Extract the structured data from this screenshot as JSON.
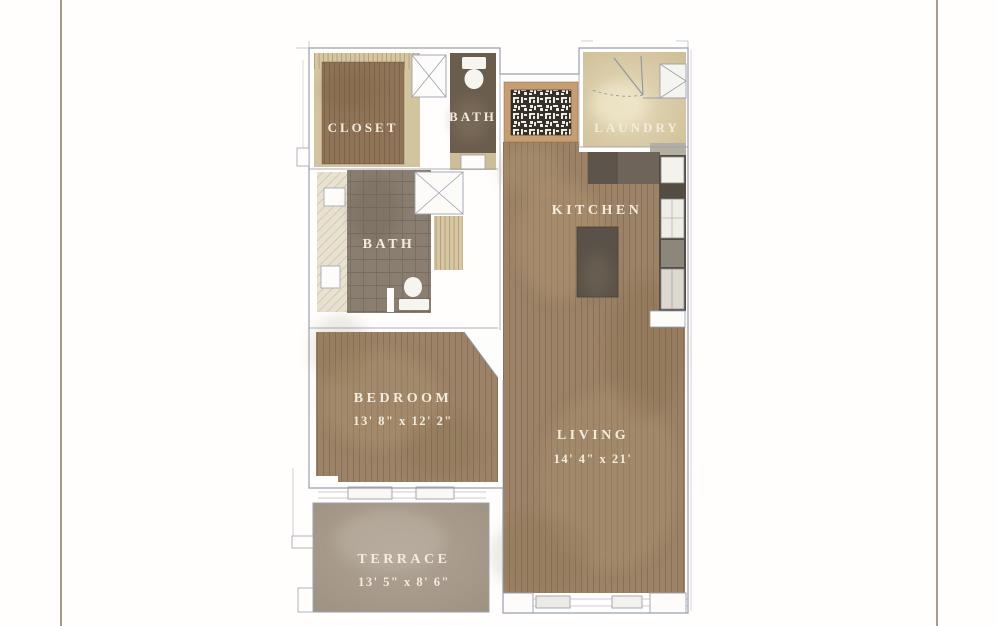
{
  "page": {
    "background": "#fffefd",
    "border_lines": {
      "color": "#a89b82",
      "left_x": 60,
      "right_x": 936
    }
  },
  "floorplan": {
    "rooms": {
      "closet": {
        "label": "CLOSET"
      },
      "bath_upper": {
        "label": "BATH"
      },
      "laundry": {
        "label": "LAUNDRY"
      },
      "kitchen": {
        "label": "KITCHEN"
      },
      "bath_main": {
        "label": "BATH"
      },
      "bedroom": {
        "label": "BEDROOM",
        "dimensions": "13' 8\" x 12' 2\""
      },
      "living": {
        "label": "LIVING",
        "dimensions": "14' 4\" x 21'"
      },
      "terrace": {
        "label": "TERRACE",
        "dimensions": "13' 5\" x 8' 6\""
      }
    },
    "features": [
      "entry-mosaic-rug",
      "closet-rod",
      "toilet",
      "shower-stall",
      "kitchen-island",
      "refrigerator",
      "washer-dryer-cabinet",
      "door-swing",
      "windows",
      "vanity-sink"
    ],
    "colors": {
      "wood_floor": "#9c8266",
      "rug_brown": "#8f7457",
      "bath_tile": "#8a7e71",
      "bath_dark": "#6b5d4e",
      "laundry_beige": "#d9cba7",
      "terrace_stone": "#a59889",
      "entry_rug_border": "#c79d72",
      "entry_rug_dark": "#34302a",
      "counter_dark": "#534c42",
      "wall_line": "#99a0ac",
      "label_text": "#f3ecdd"
    }
  }
}
